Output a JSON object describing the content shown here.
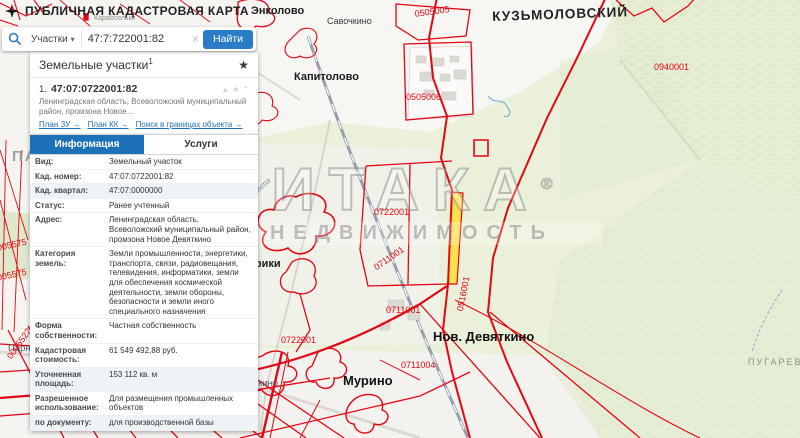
{
  "colors": {
    "accent": "#1d71b8",
    "parcel_line": "#e30613",
    "selected_parcel": "#ffe14d"
  },
  "header": {
    "title": "ПУБЛИЧНАЯ КАДАСТРОВАЯ КАРТА"
  },
  "search": {
    "category": "Участки",
    "caret": "▾",
    "query": "47:7:722001:82",
    "clear": "×",
    "button": "Найти"
  },
  "panel": {
    "title": "Земельные участки",
    "title_sup": "1",
    "fav_star": "★",
    "item": {
      "index": "1.",
      "cadastral_number": "47:07:0722001:82",
      "icons": {
        "warn": "▲",
        "star": "★",
        "collapse": "⌃"
      },
      "address_preview": "Ленинградская область, Всеволожский муниципальный район, промзона Новое...",
      "links": [
        {
          "label": "План ЗУ →"
        },
        {
          "label": "План КК →"
        },
        {
          "label": "Поиск в границах объекта →"
        }
      ]
    },
    "tabs": [
      {
        "label": "Информация",
        "active": true
      },
      {
        "label": "Услуги",
        "active": false
      }
    ],
    "rows": [
      {
        "label": "Вид:",
        "value": "Земельный участок"
      },
      {
        "label": "Кад. номер:",
        "value": "47:07:0722001:82"
      },
      {
        "label": "Кад. квартал:",
        "value": "47:07:0000000"
      },
      {
        "label": "Статус:",
        "value": "Ранее учтенный"
      },
      {
        "label": "Адрес:",
        "value": "Ленинградская область, Всеволожский муниципальный район, промзона Новое Девяткино"
      },
      {
        "label": "Категория земель:",
        "value": "Земли промышленности, энергетики, транспорта, связи, радиовещания, телевидения, информатики, земли для обеспечения космической деятельности, земли обороны, безопасности и земли иного специального назначения"
      },
      {
        "label": "Форма собственности:",
        "value": "Частная собственность"
      },
      {
        "label": "Кадастровая стоимость:",
        "value": "61 549 492,88 руб."
      },
      {
        "label": "Уточненная площадь:",
        "value": "153 112 кв. м"
      },
      {
        "label": "Разрешенное использование:",
        "value": "Для размещения промышленных объектов"
      },
      {
        "label": "по документу:",
        "value": "для производственной базы"
      }
    ]
  },
  "map": {
    "watermark": {
      "brand": "ИТАКА",
      "reg": "®",
      "sub": "НЕДВИЖИМОСТЬ"
    },
    "labels": [
      {
        "text": "Энколово"
      },
      {
        "text": "Савочкино"
      },
      {
        "text": "Капитолово"
      },
      {
        "text": "КУЗЬМОЛОВСКИЙ"
      },
      {
        "text": "Карабсельки"
      },
      {
        "text": "0505005"
      },
      {
        "text": "0505006"
      },
      {
        "text": "0940001"
      },
      {
        "text": "0722001"
      },
      {
        "text": "0722001"
      },
      {
        "text": "0711001"
      },
      {
        "text": "0711001"
      },
      {
        "text": "0516001"
      },
      {
        "text": "0711004"
      },
      {
        "text": "Нов. Девяткино"
      },
      {
        "text": "Мурино"
      },
      {
        "text": "Девяткино"
      },
      {
        "text": "Парнас"
      },
      {
        "text": "0580301"
      },
      {
        "text": "0005522"
      },
      {
        "text": "0005523"
      },
      {
        "text": "0005535"
      },
      {
        "text": "0005517"
      },
      {
        "text": "005575"
      },
      {
        "text": "005575"
      },
      {
        "text": "ПУГАРЕВО"
      },
      {
        "text": "Лаврики"
      },
      {
        "text": "Охта"
      },
      {
        "text": "ПА"
      }
    ]
  }
}
